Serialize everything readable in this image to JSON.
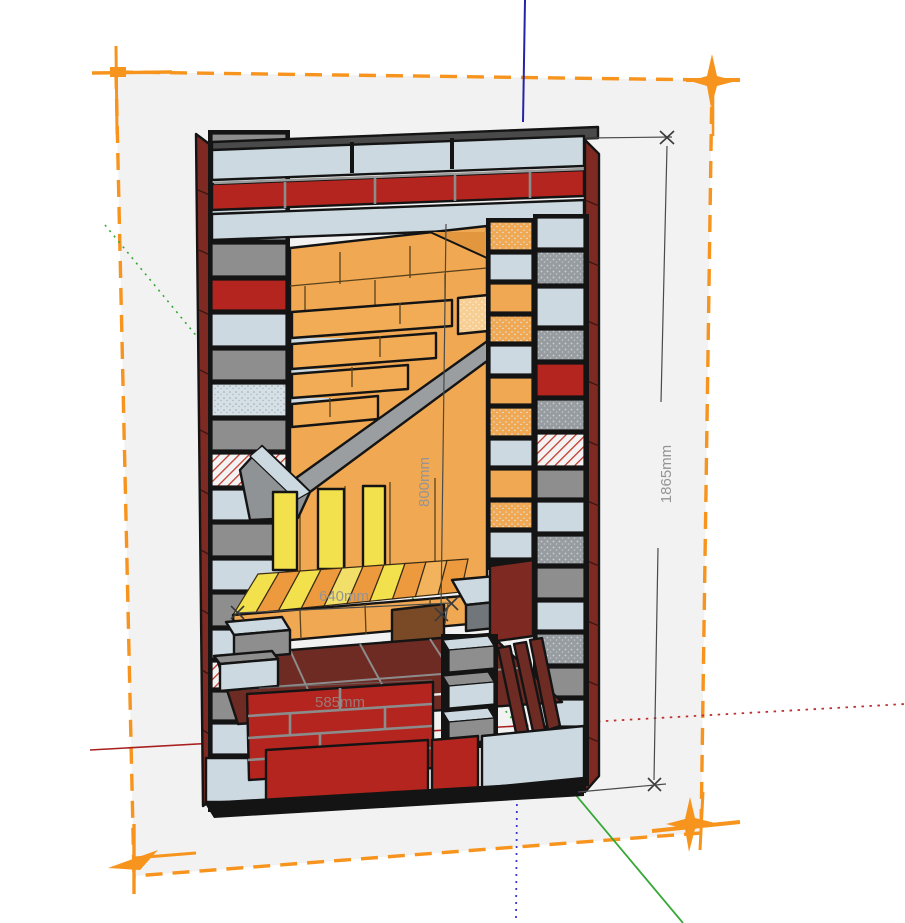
{
  "scene": {
    "description": "3D cutaway model of a brick masonry heater shown in a CAD viewport with selection bounding box and drawing axes",
    "selection_region_fill": "#F2F2F2",
    "viewport_background": "#FFFFFF"
  },
  "dimensions": {
    "overall_height": {
      "label": "1865mm"
    },
    "firebox_height": {
      "label": "800mm"
    },
    "firebox_width": {
      "label": "640mm"
    },
    "base_course_width": {
      "label": "585mm"
    }
  },
  "axes": {
    "blue_vertical": "#2424A8",
    "red_horizontal": "#A81F1F",
    "green_diagonal": "#35A835"
  },
  "colors": {
    "selection-orange": "#F7941E",
    "viewport-bg": "#FFFFFF",
    "selection-fill": "#F2F2F2",
    "brick-red": "#B3251E",
    "brick-dark-red": "#7E2A22",
    "brick-maroon": "#6E2B24",
    "firebrick-orange": "#F0A852",
    "firebrick-orange-dark": "#E2973F",
    "firebrick-yellow": "#F2E14D",
    "concrete-light": "#CCD9E0",
    "block-gray": "#8E8E8E",
    "steel-gray": "#9A9EA1",
    "cap-dark": "#4A4A4A",
    "dimension-text": "#949494",
    "axis-blue": "#2424A8",
    "axis-red": "#A81F1F",
    "axis-green": "#35A835"
  }
}
